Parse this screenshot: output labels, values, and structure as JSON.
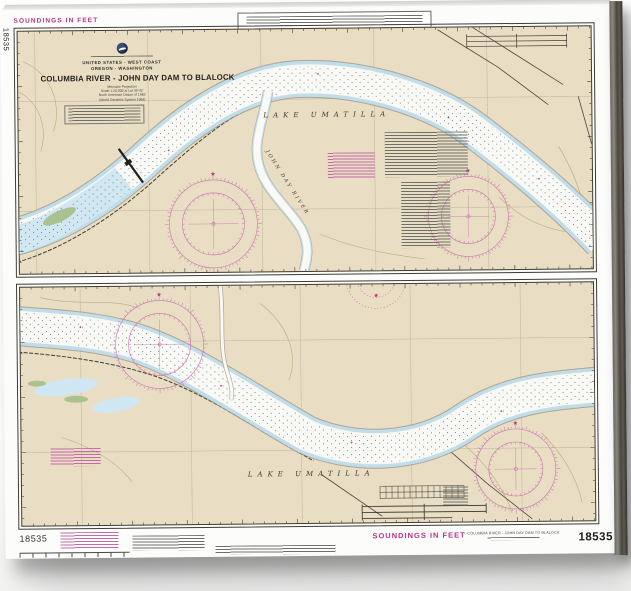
{
  "chart": {
    "number": "18535",
    "soundings_unit_top": "SOUNDINGS IN FEET",
    "soundings_unit_bottom": "SOUNDINGS IN FEET",
    "edge_number_vertical": "18535",
    "header": {
      "nation_line": "UNITED STATES - WEST COAST",
      "states_line": "OREGON - WASHINGTON",
      "title": "COLUMBIA RIVER - JOHN DAY DAM TO BLALOCK",
      "projection_lines": [
        "Mercator Projection",
        "Scale 1:20,000 at Lat 45°42'",
        "North American Datum of 1983",
        "(World Geodetic System 1984)"
      ]
    },
    "labels": {
      "lake_upper": "LAKE UMATILLA",
      "lake_lower": "LAKE UMATILLA",
      "tributary": "JOHN DAY RIVER"
    },
    "footer": {
      "number_left": "18535",
      "title_small": "COLUMBIA RIVER - JOHN DAY DAM TO BLALOCK",
      "number_right": "18535"
    },
    "colors": {
      "magenta": "#b5328e",
      "land": "#e9dec3",
      "water": "#f9faf6",
      "shallow": "#cfe7f2",
      "compass": "#c873ae"
    }
  }
}
